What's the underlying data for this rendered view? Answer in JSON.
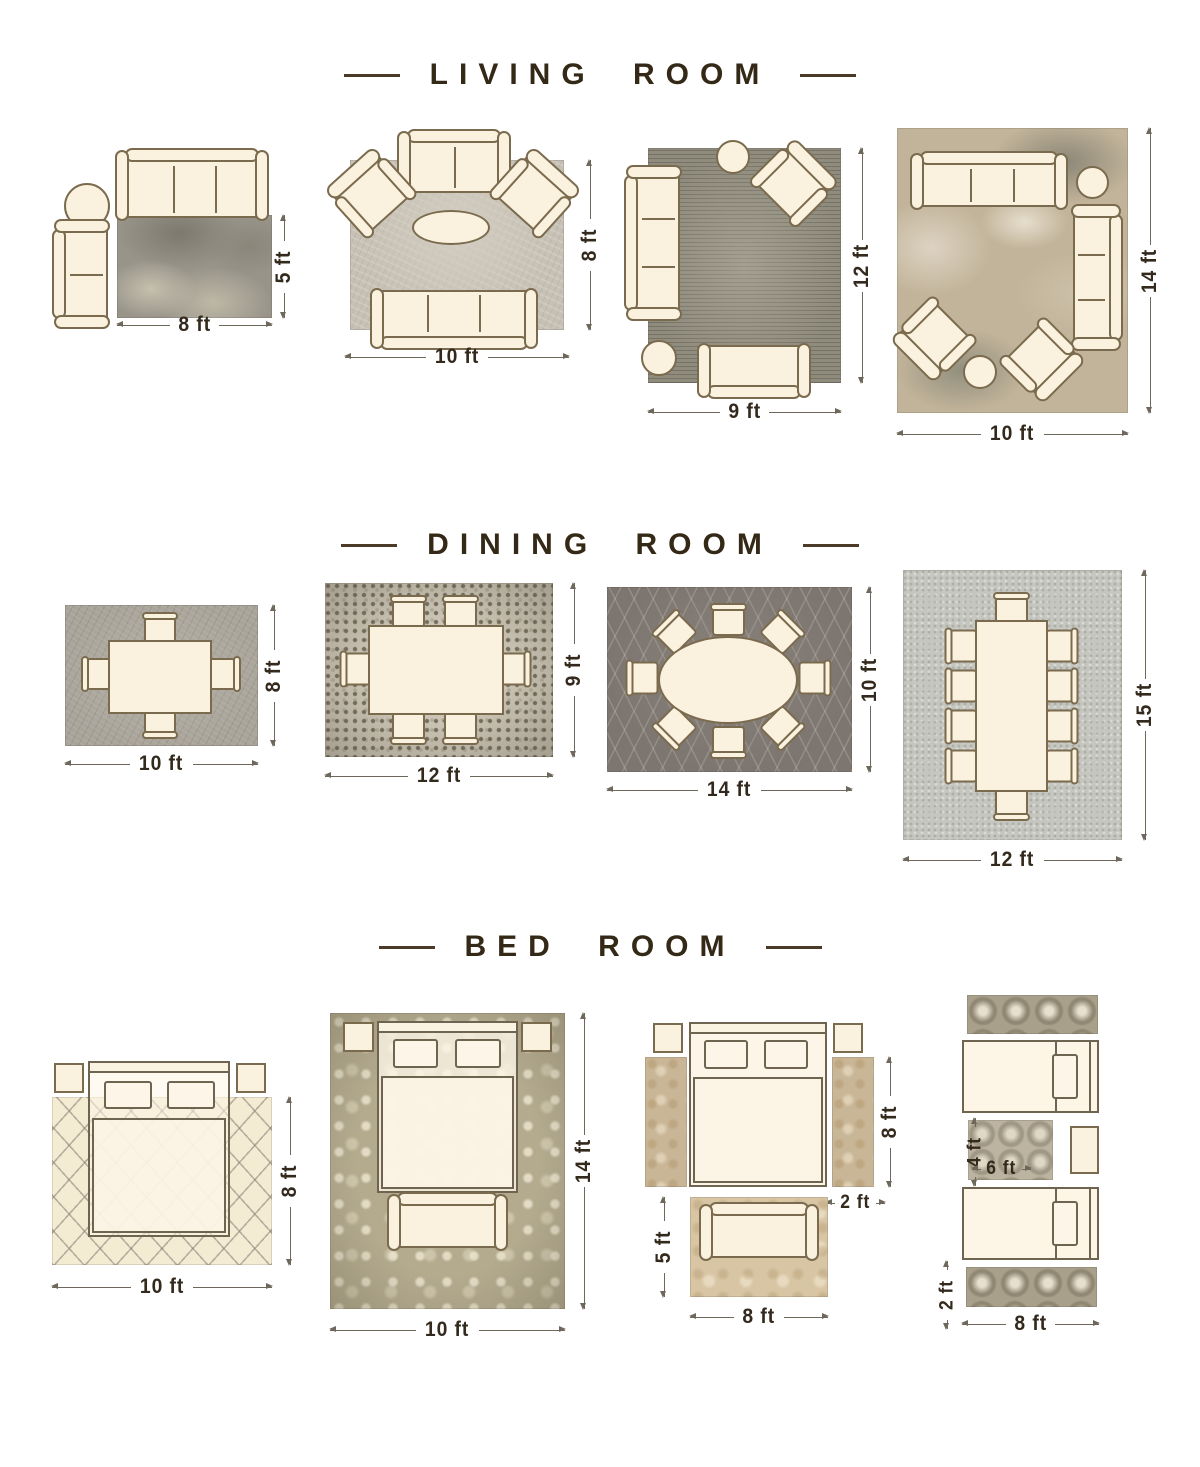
{
  "sections": [
    {
      "id": "living-room",
      "title": "LIVING ROOM",
      "diagrams": [
        {
          "name": "living-rug-8x5",
          "width_label": "8 ft",
          "height_label": "5 ft"
        },
        {
          "name": "living-rug-10x8",
          "width_label": "10 ft",
          "height_label": "8 ft"
        },
        {
          "name": "living-rug-9x12",
          "width_label": "9 ft",
          "height_label": "12 ft"
        },
        {
          "name": "living-rug-10x14",
          "width_label": "10 ft",
          "height_label": "14 ft"
        }
      ]
    },
    {
      "id": "dining-room",
      "title": "DINING ROOM",
      "diagrams": [
        {
          "name": "dining-rug-10x8",
          "width_label": "10 ft",
          "height_label": "8 ft"
        },
        {
          "name": "dining-rug-12x9",
          "width_label": "12 ft",
          "height_label": "9 ft"
        },
        {
          "name": "dining-rug-14x10",
          "width_label": "14 ft",
          "height_label": "10 ft"
        },
        {
          "name": "dining-rug-12x15",
          "width_label": "12 ft",
          "height_label": "15 ft"
        }
      ]
    },
    {
      "id": "bed-room",
      "title": "BED ROOM",
      "diagrams": [
        {
          "name": "bed-rug-10x8",
          "width_label": "10 ft",
          "height_label": "8 ft"
        },
        {
          "name": "bed-rug-10x14",
          "width_label": "10 ft",
          "height_label": "14 ft"
        },
        {
          "name": "bed-side-runners",
          "runner_height_label": "8 ft",
          "runner_width_label": "2 ft",
          "foot_rug_height_label": "5 ft",
          "foot_rug_width_label": "8 ft"
        },
        {
          "name": "bed-twin-runners",
          "small_rug_height_label": "4 ft",
          "small_rug_width_label": "6 ft",
          "runner_width_label": "2 ft",
          "runner_length_label": "8 ft"
        }
      ]
    }
  ],
  "colors": {
    "title_text": "#342817",
    "dimension_text": "#33291d",
    "furniture_fill": "#faf1de",
    "furniture_outline": "#7b6b4e",
    "background": "#ffffff"
  }
}
